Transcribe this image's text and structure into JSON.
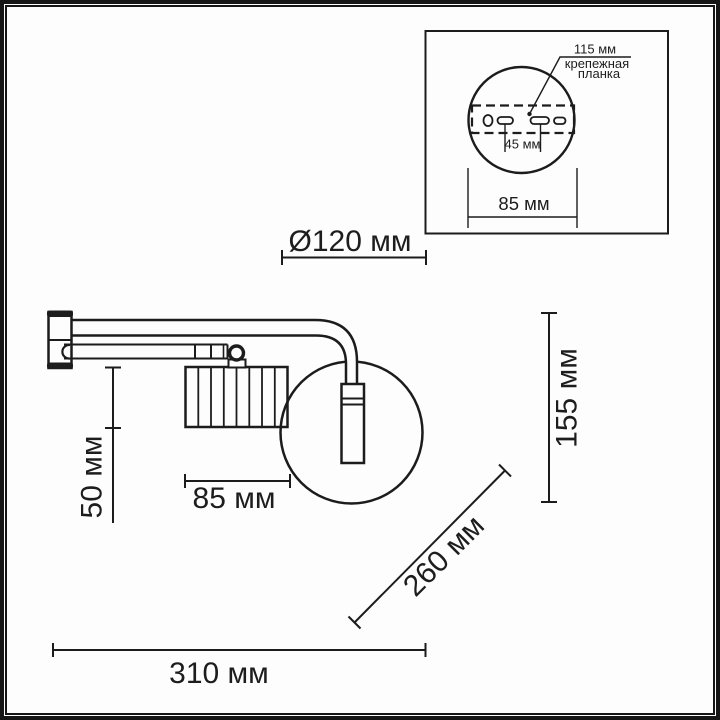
{
  "colors": {
    "line": "#1c1c1c",
    "text": "#1d1d1d",
    "background": "#ffffff"
  },
  "main_view": {
    "dimensions": {
      "shade_diameter": "Ø120 мм",
      "drop_height": "50 мм",
      "shade_width": "85 мм",
      "fixture_height": "155 мм",
      "arm_diagonal": "260 мм",
      "total_width": "310 мм"
    }
  },
  "inset_view": {
    "dimensions": {
      "plate_length": "115 мм",
      "hole_spacing": "45 мм",
      "base_width": "85 мм"
    },
    "labels": {
      "mount_plate_line1": "крепежная",
      "mount_plate_line2": "планка"
    }
  }
}
